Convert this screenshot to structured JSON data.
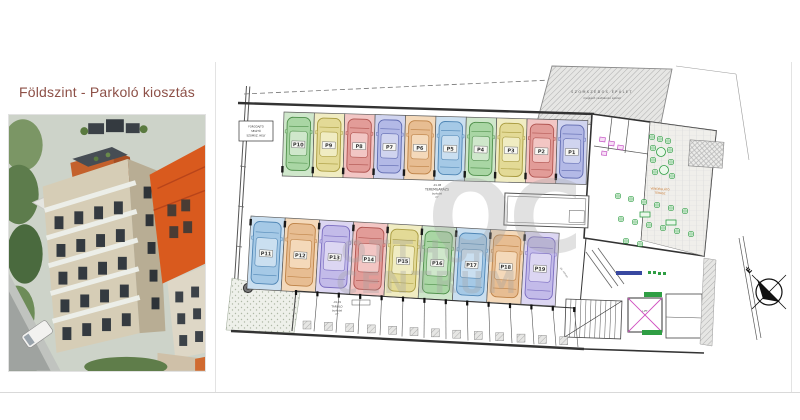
{
  "header": {
    "title": "Földszint - Parkoló kiosztás"
  },
  "plan": {
    "watermark": {
      "monogram": "OC",
      "word1": "OTTHON",
      "word2": "CENTRUM"
    },
    "compass_label": "É",
    "neighbor": {
      "line1": "SZOMSZÉDOS ÉPÜLET",
      "line2": "meglévő csatlakozó épület"
    },
    "garage_room": {
      "code": "-01.08",
      "name": "TEREMGARÁZS",
      "line3": "burkolat",
      "line4": "m²"
    },
    "storage_room": {
      "code": "-01.09",
      "name": "TÁROLÓ",
      "line3": "burkolat",
      "line4": "m²"
    },
    "turn_note": [
      "FORGÓAJTÓ",
      "SEGÍTŐ",
      "SZOMSZ. HELY"
    ],
    "terrace_note": [
      "VENDÉGLÁTÓ",
      "TERASZ"
    ],
    "lift_label": "LIFT",
    "ramp_label": "gk. rámpa",
    "spots_top": [
      {
        "label": "P10",
        "color": "green"
      },
      {
        "label": "P9",
        "color": "yellow"
      },
      {
        "label": "P8",
        "color": "red"
      },
      {
        "label": "P7",
        "color": "periwinkle"
      },
      {
        "label": "P6",
        "color": "orange"
      },
      {
        "label": "P5",
        "color": "lightblue"
      },
      {
        "label": "P4",
        "color": "green"
      },
      {
        "label": "P3",
        "color": "yellow"
      },
      {
        "label": "P2",
        "color": "red"
      },
      {
        "label": "P1",
        "color": "periwinkle"
      }
    ],
    "spots_middle": [
      {
        "label": "P11",
        "color": "lightblue"
      },
      {
        "label": "P12",
        "color": "orange"
      },
      {
        "label": "P13",
        "color": "lavender"
      },
      {
        "label": "P14",
        "color": "red"
      },
      {
        "label": "P15",
        "color": "yellow"
      },
      {
        "label": "P16",
        "color": "green"
      },
      {
        "label": "P17",
        "color": "lightblue"
      },
      {
        "label": "P18",
        "color": "orange"
      },
      {
        "label": "P19",
        "color": "lavender"
      }
    ],
    "palette": {
      "green": {
        "stall": "#cfe7cb",
        "car": "#a9d6a4",
        "stroke": "#4e8f4a"
      },
      "yellow": {
        "stall": "#f0ecc2",
        "car": "#e3da96",
        "stroke": "#a89a3e"
      },
      "red": {
        "stall": "#f2c6c4",
        "car": "#e29c98",
        "stroke": "#b05450"
      },
      "periwinkle": {
        "stall": "#d0d4ef",
        "car": "#b3b9e6",
        "stroke": "#5f6ab0"
      },
      "lightblue": {
        "stall": "#cadff0",
        "car": "#a5c9e6",
        "stroke": "#4f86b5"
      },
      "orange": {
        "stall": "#f4d9ba",
        "car": "#e7bd92",
        "stroke": "#bd8145"
      },
      "lavender": {
        "stall": "#dcd6f2",
        "car": "#c3bbe9",
        "stroke": "#7a6cc0"
      }
    },
    "colors": {
      "furniture": "#2f9e44",
      "fixture": "#c455c4",
      "watermark": "#a3a3a3",
      "wall": "#333333"
    }
  }
}
